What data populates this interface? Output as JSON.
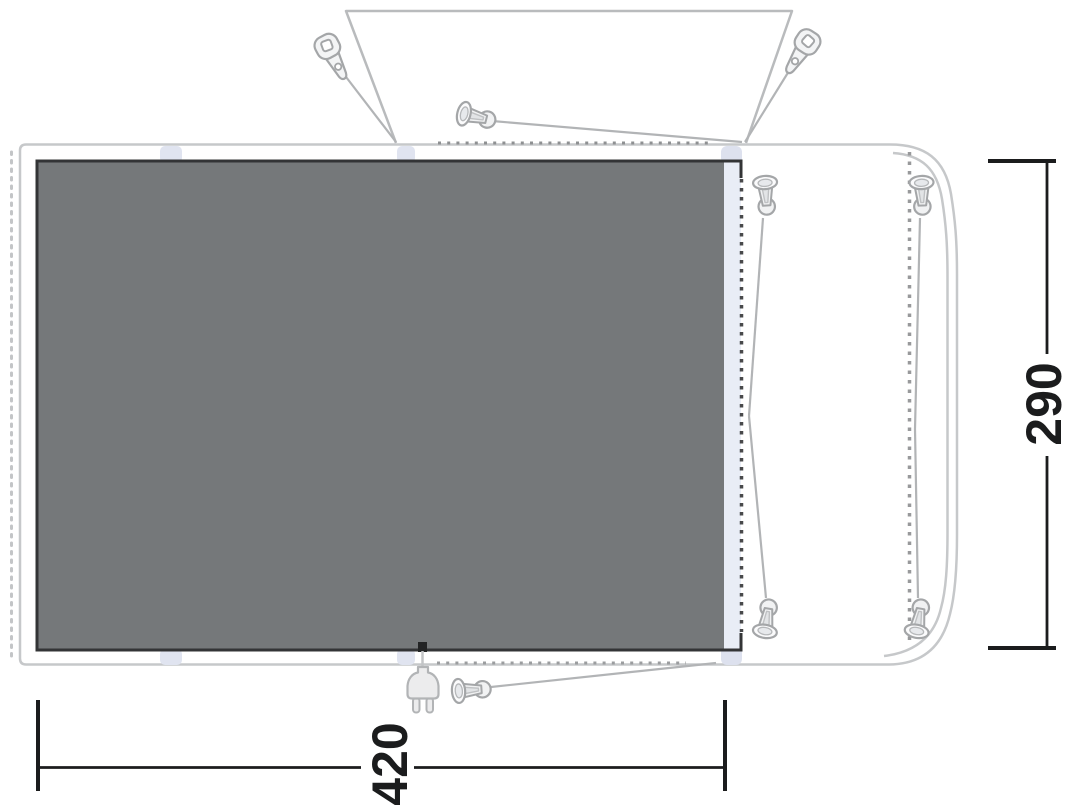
{
  "diagram": {
    "kind": "awning-floorplan",
    "dimensions": {
      "width_label": "420",
      "depth_label": "290"
    },
    "colors": {
      "background": "#ffffff",
      "groundsheet_fill": "#75787a",
      "groundsheet_border": "#333436",
      "awning_outline": "#c6c8ca",
      "canopy_outline": "#b9bbbd",
      "connection_tab": "#e0e4f0",
      "tunnel_strip": "#e9edf6",
      "zip_dots": "#48494b",
      "guy_line": "#b2b4b6",
      "icon_stroke": "#a4a6a8",
      "icon_fill": "#f1f2f3",
      "dimension_line": "#1b1c1d",
      "cable": "#232425"
    },
    "icons": [
      "peg-clip-icon",
      "peg-icon",
      "power-plug-icon",
      "zip-dotted-line",
      "guy-line"
    ]
  }
}
